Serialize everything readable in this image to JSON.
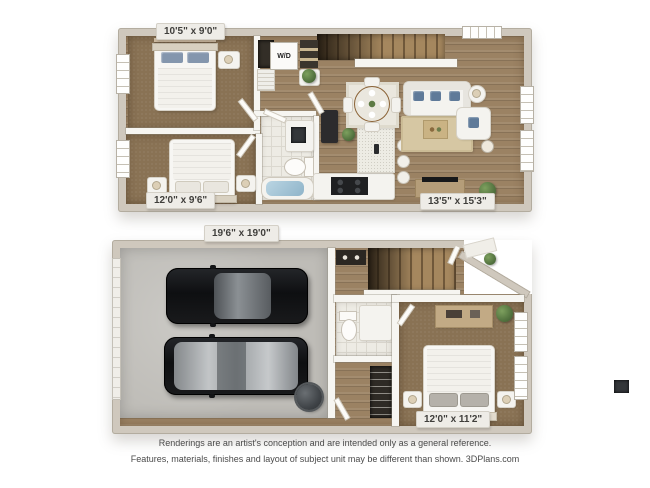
{
  "floorplan": {
    "upper": {
      "bedroom1_dim": "10'5\" x 9'0\"",
      "bedroom2_dim": "12'0\" x 9'6\"",
      "living_dim": "13'5\" x 15'3\"",
      "washer_dryer": "W/D"
    },
    "lower": {
      "garage_dim": "19'6\" x 19'0\"",
      "bedroom_dim": "12'0\" x 11'2\""
    }
  },
  "footer": {
    "line1": "Renderings are an artist's conception and are intended only as a general reference.",
    "line2": "Features, materials, finishes and layout of subject unit may be different than shown. 3DPlans.com"
  },
  "colors": {
    "wall": "#cfc8bd",
    "carpet": "#897254",
    "wood_floor": "#9b8263",
    "tile": "#edebe4",
    "concrete": "#bebcb7",
    "rug_beige": "#d6c7a3",
    "pillow_blue": "#5f7a99",
    "tub_water": "#a7c9db",
    "car_dark": "#1a1b1d",
    "label_bg": "#eeece7",
    "label_text": "#3f3e3b"
  }
}
